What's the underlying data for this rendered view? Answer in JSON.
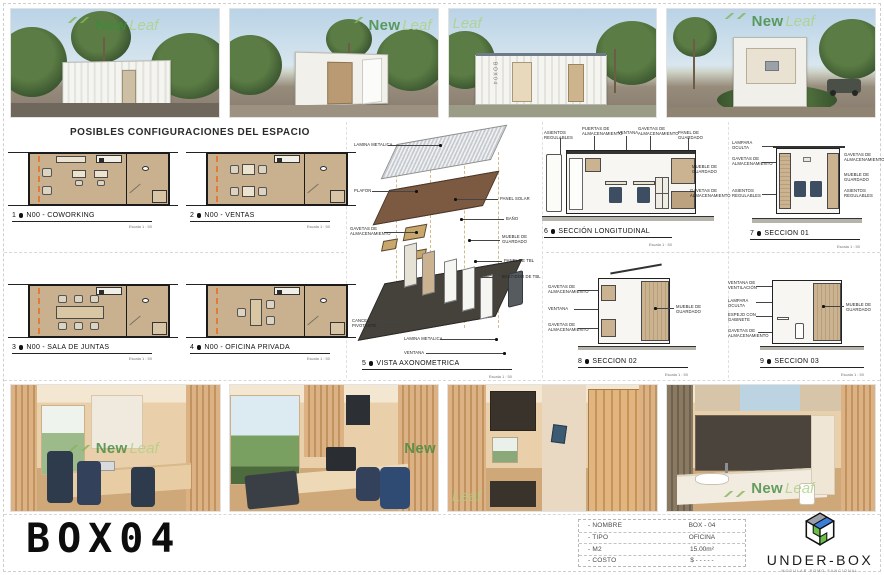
{
  "watermark": {
    "new": "New",
    "leaf": "Leaf"
  },
  "gallery_top": {
    "box_label": "BOX04"
  },
  "middle": {
    "heading": "POSIBLES CONFIGURACIONES DEL ESPACIO"
  },
  "plans": [
    {
      "num": "1",
      "title": "N00 - COWORKING",
      "scale": "Escala 1 : 50"
    },
    {
      "num": "2",
      "title": "N00 - VENTAS",
      "scale": "Escala 1 : 50"
    },
    {
      "num": "3",
      "title": "N00 - SALA DE JUNTAS",
      "scale": "Escala 1 : 50"
    },
    {
      "num": "4",
      "title": "N00 - OFICINA PRIVADA",
      "scale": "Escala 1 : 50"
    }
  ],
  "axo": {
    "num": "5",
    "title": "VISTA AXONOMETRICA",
    "scale": "Escala 1 : 50",
    "labels": [
      "LAMINA METALICA",
      "PLAFON",
      "GAVETAS DE ALMACENAMIENTO",
      "CANCEL PIVOTANTE",
      "PANEL SOLAR",
      "BAÑO",
      "MUEBLE DE GUARDADO",
      "PANEL DE TBL",
      "BASTIDOR DE TBL",
      "LAMINA METALICA",
      "VENTANA"
    ]
  },
  "sections": [
    {
      "num": "6",
      "title": "SECCIÓN LONGITUDINAL",
      "scale": "Escala 1 : 50",
      "labels": [
        "ASIENTOS REGULABLES",
        "PUERTAS DE ALMACENAMIENTO",
        "VENTANA",
        "GAVETAS DE ALMACENAMIENTO",
        "PANEL DE GUARDADO",
        "MUEBLE DE GUARDADO",
        "GAVETAS DE ALMACENAMIENTO"
      ]
    },
    {
      "num": "7",
      "title": "SECCION 01",
      "scale": "Escala 1 : 50",
      "labels": [
        "LAMPARA OCULTA",
        "GAVETAS DE ALMACENAMIENTO",
        "ASIENTOS REGULABLES",
        "GAVETAS DE ALMACENAMIENTO",
        "MUEBLE DE GUARDADO",
        "ASIENTOS REGULABLES"
      ]
    },
    {
      "num": "8",
      "title": "SECCION 02",
      "scale": "Escala 1 : 50",
      "labels": [
        "GAVETAS DE ALMACENAMIENTO",
        "VENTANA",
        "GAVETAS DE ALMACENAMIENTO",
        "MUEBLE DE GUARDADO"
      ]
    },
    {
      "num": "9",
      "title": "SECCION 03",
      "scale": "Escala 1 : 50",
      "labels": [
        "VENTANA DE VENTILACIÓN",
        "LAMPARA OCULTA",
        "ESPEJO CON GABINETE",
        "GAVETAS DE ALMACENAMIENTO",
        "MUEBLE DE GUARDADO"
      ]
    }
  ],
  "footer": {
    "title": "BOX04",
    "table": {
      "rows": [
        {
          "label": "- NOMBRE",
          "value": "BOX - 04"
        },
        {
          "label": "- TIPO",
          "value": "OFICINA"
        },
        {
          "label": "- M2",
          "value": "15.00m²"
        },
        {
          "label": "- COSTO",
          "value": "$ - - - - -"
        }
      ]
    },
    "brand": {
      "name": "UNDER-BOX",
      "tagline": "MODULAR ROMO FUNCIONAL"
    }
  },
  "colors": {
    "accent_orange": "#e07b39",
    "brand_green": "#6abf4b",
    "brand_blue": "#3b7dd8",
    "watermark_green": "#3f8a3d"
  }
}
